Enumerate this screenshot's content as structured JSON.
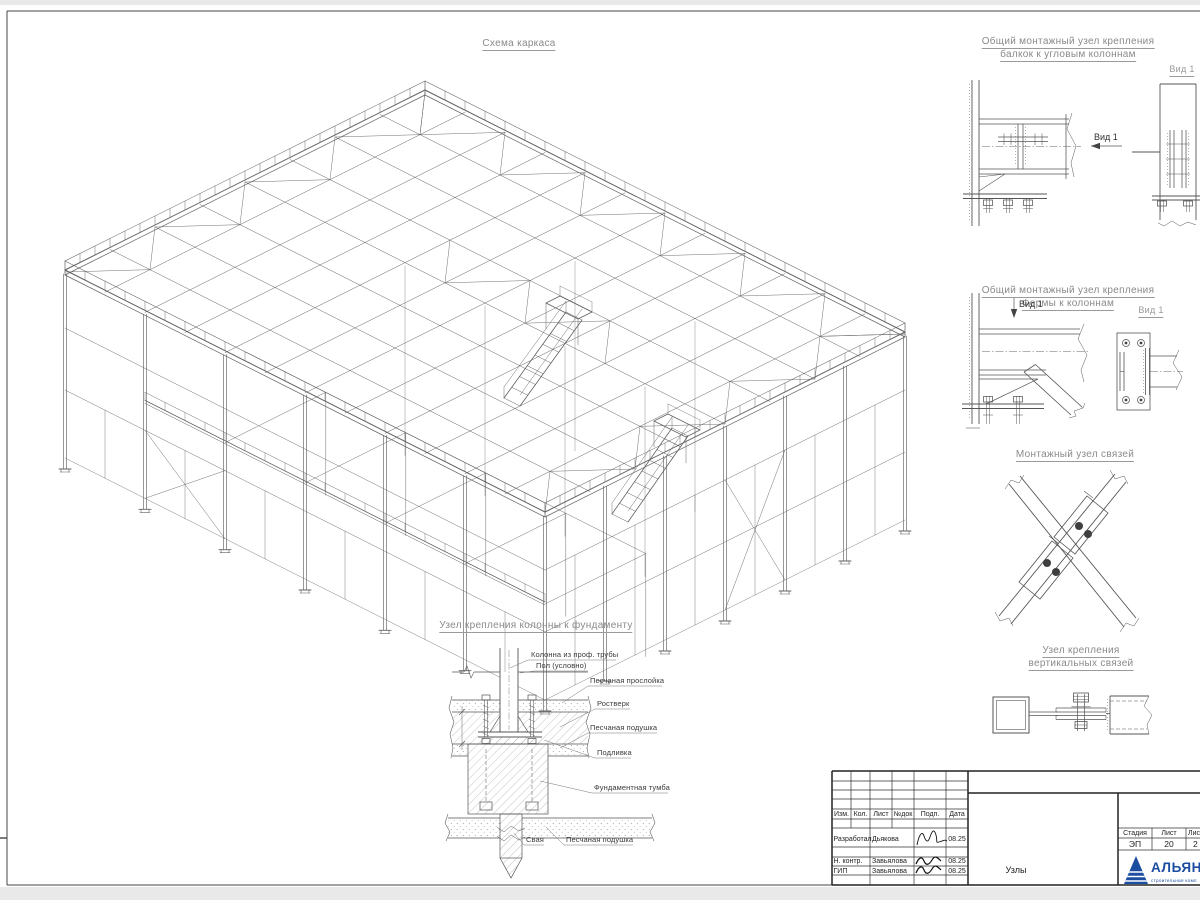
{
  "page": {
    "main_title": "Схема каркаса",
    "details": {
      "d1": {
        "title1": "Общий монтажный узел крепления",
        "title2": "балкок к угловым колоннам",
        "view_label": "Вид 1",
        "view_title": "Вид 1"
      },
      "d2": {
        "title1": "Общий монтажный узел крепления",
        "title2": "Фермы к колоннам",
        "view_label": "Вид 1",
        "view_title": "Вид 1"
      },
      "d3": {
        "title": "Монтажный узел связей"
      },
      "d4": {
        "title1": "Узел крепления",
        "title2": "вертикальных связей"
      }
    },
    "foundation": {
      "title": "Узел крепления колонны к фундаменту",
      "labels": {
        "column": "Колонна из проф. трубы",
        "floor": "Пол (условно)",
        "sand_layer": "Песчаная прослойка",
        "grillage": "Ростверк",
        "sand_cushion": "Песчаная подушка",
        "grout": "Подливка",
        "foundation_block": "Фундаментная тумба",
        "pile": "Свая",
        "sand_cushion2": "Песчаная подушка"
      }
    },
    "title_block": {
      "header_cols": [
        "Изм.",
        "Кол.",
        "Лист",
        "№док",
        "Подп.",
        "Дата"
      ],
      "rows": [
        {
          "role": "Разработал",
          "name": "Дьякова",
          "date": "08.25"
        },
        {
          "role": "Н. контр.",
          "name": "Завьялова",
          "date": "08.25"
        },
        {
          "role": "ГИП",
          "name": "Завьялова",
          "date": "08.25"
        }
      ],
      "stage_label": "Стадия",
      "sheet_label": "Лист",
      "sheets_label": "Лис",
      "stage_value": "ЭП",
      "sheet_value": "20",
      "sheets_value": "2",
      "doc_name": "Узлы",
      "logo_text": "АЛЬЯН",
      "logo_subtext": "строительная комп",
      "logo_color": "#1c4da0"
    }
  }
}
